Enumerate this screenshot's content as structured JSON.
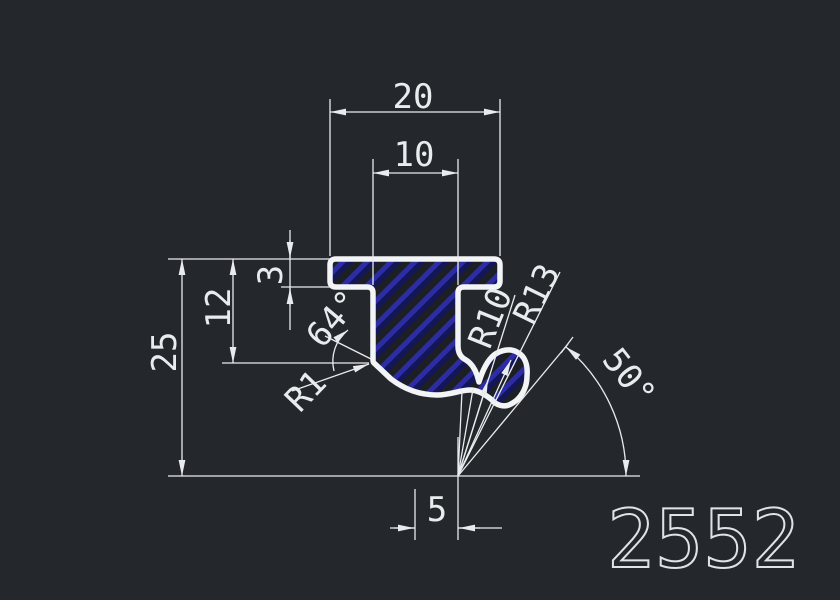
{
  "drawing": {
    "part_number": "2552",
    "dimensions": {
      "top_width": "20",
      "stem_width": "10",
      "flange_thickness": "3",
      "left_inner_height": "12",
      "total_height": "25",
      "bottom_offset": "5"
    },
    "angles": {
      "left": "64°",
      "right": "50°"
    },
    "radii": {
      "r1": "R1",
      "r10": "R10",
      "r13": "R13"
    },
    "colors": {
      "background": "#24282c",
      "line": "#e9ecee",
      "outline": "#f2f4f6",
      "hatch_fill": "#1c1f24",
      "hatch_bright": "#2c2da6",
      "hatch_dark": "#14165a",
      "big_number": "#dfe3e6"
    }
  }
}
